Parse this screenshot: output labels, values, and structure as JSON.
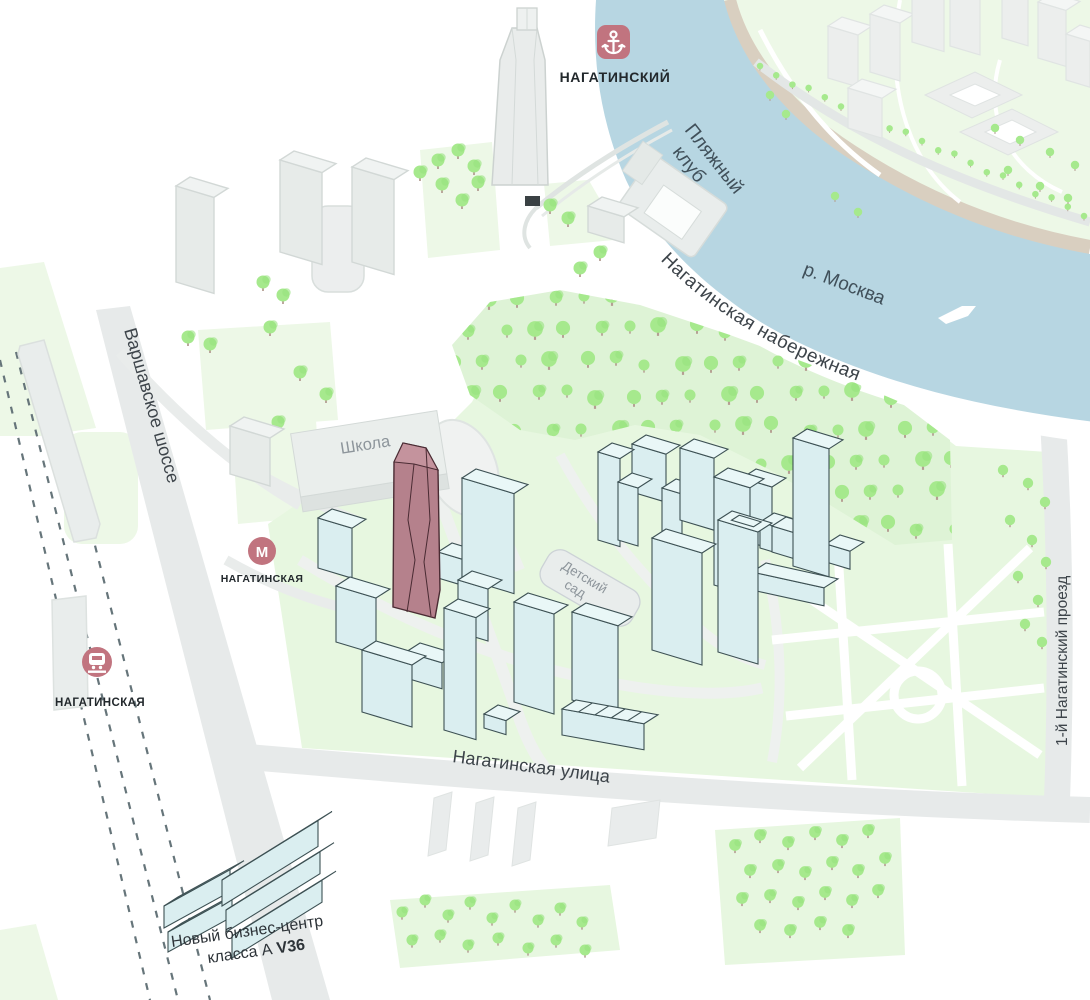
{
  "brand": {
    "label": "НАГАТИНСКИЙ"
  },
  "transit": {
    "metro_letter": "М",
    "metro_label": "НАГАТИНСКАЯ",
    "rail_label": "НАГАТИНСКАЯ"
  },
  "streets": {
    "embankment": "Нагатинская набережная",
    "varshavskoe": "Варшавское шоссе",
    "nagatinskaya_street": "Нагатинская улица",
    "proezd": "1-й Нагатинский проезд"
  },
  "river": {
    "label": "р. Москва",
    "beach_line1": "Пляжный",
    "beach_line2": "клуб"
  },
  "places": {
    "school": "Школа",
    "kg_line1": "Детский",
    "kg_line2": "сад"
  },
  "business_center": {
    "line1": "Новый бизнес-центр",
    "line2_prefix": "класса А ",
    "line2_bold": "V36"
  },
  "colors": {
    "brand_rose": "#c1747f",
    "highlight_face": "#b5818c",
    "highlight_top": "#c4939d",
    "river_blue": "#b7d6e2",
    "park_green": "#e7f7e0",
    "pale_green": "#edf8e7",
    "tree_green": "#a6e98d",
    "road_gray": "#e7eaea",
    "tan_path": "#d9cfc0"
  }
}
